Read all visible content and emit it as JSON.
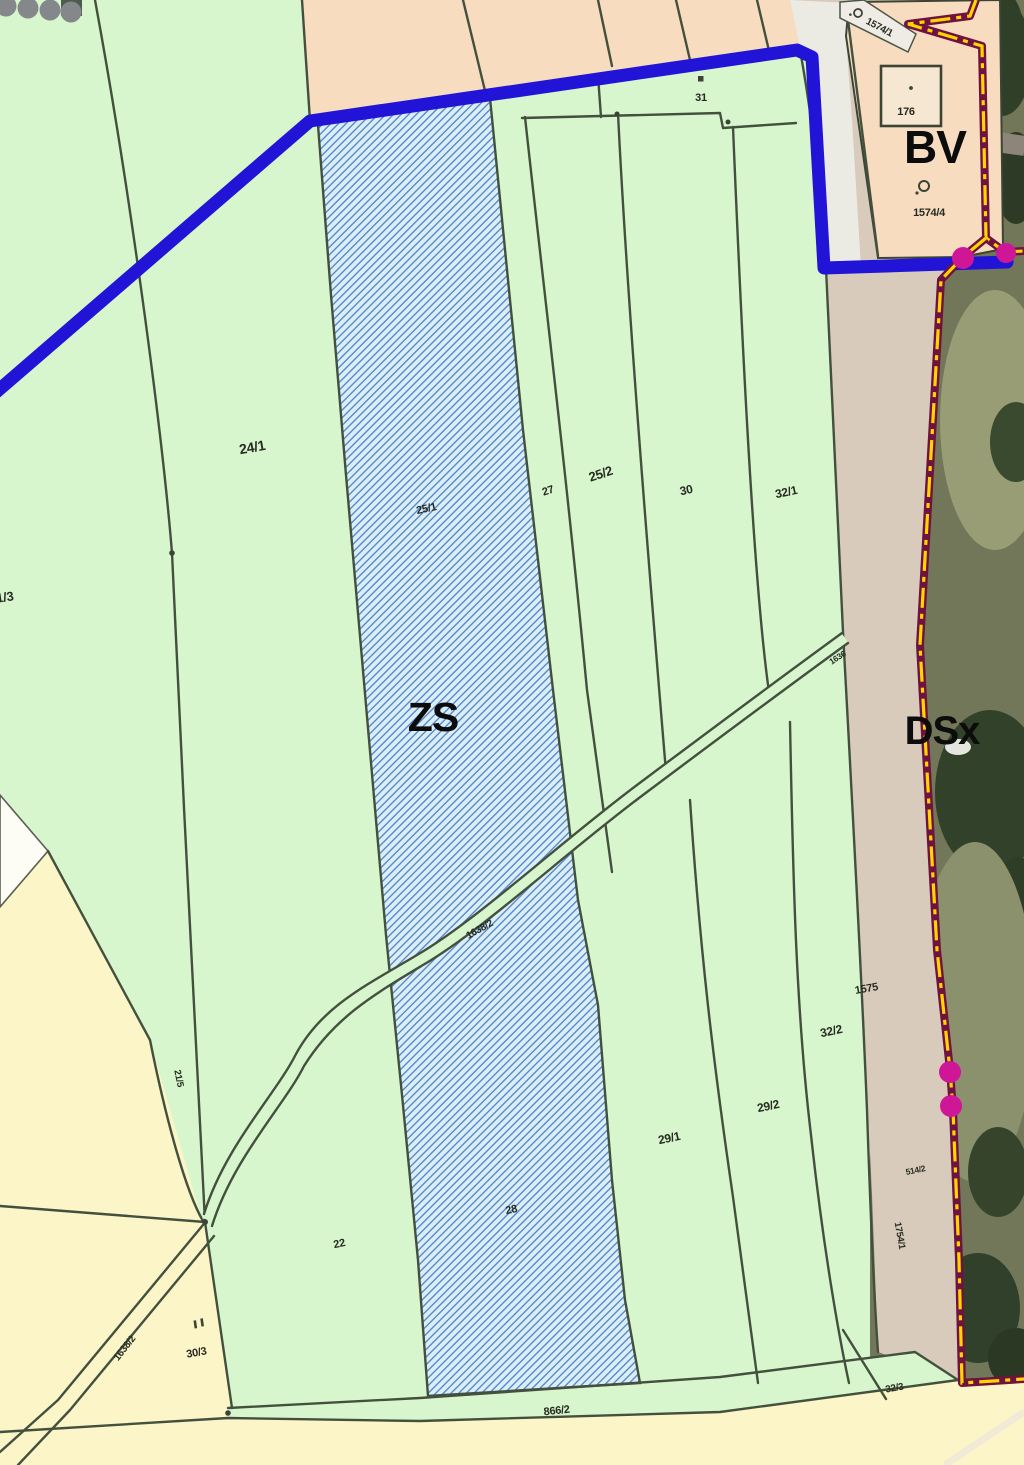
{
  "zones": {
    "zs": "ZS",
    "bv": "BV",
    "dsx": "DSx"
  },
  "parcels": {
    "p21_3": "21/3",
    "p24_1": "24/1",
    "p25_1": "25/1",
    "p27": "27",
    "p25_2": "25/2",
    "p30": "30",
    "p31": "31",
    "p32_1": "32/1",
    "p176": "176",
    "p1574_1": "1574/1",
    "p1574_4": "1574/4",
    "p1575": "1575",
    "p32_2": "32/2",
    "p29_1": "29/1",
    "p29_2": "29/2",
    "p28": "28",
    "p22": "22",
    "p21_5": "21/5",
    "p30_3": "30/3",
    "p866_2": "866/2",
    "p32_3": "32/3",
    "p514_2": "514/2",
    "p1754_1": "1754/1",
    "p1638_2_road": "1638/2",
    "p1638_2_road_sw": "1638/2",
    "p1636": "1636"
  },
  "symbols": {
    "building_point": "point inside building 176",
    "land_use_circle": "orchard land-use circle symbol",
    "parcel_square_mark": "small square mark above parcel 31",
    "double_dash_mark": "double mark above parcel 30/3"
  },
  "colors": {
    "zone_green": "#d8f6cd",
    "zone_hatch_bg": "#d9eef7",
    "hatch_line_blue": "#3f74c2",
    "zone_peach": "#f8dcc0",
    "zone_yellow": "#fbf5c8",
    "water_line_blue": "#2114d6",
    "boundary_maroon": "#70123f",
    "boundary_dash_yellow": "#ffd500",
    "boundary_point_magenta": "#ce1697",
    "road_beige": "#d9cbbb",
    "road_white": "#ecebe3",
    "parcel_line": "#44503e"
  }
}
